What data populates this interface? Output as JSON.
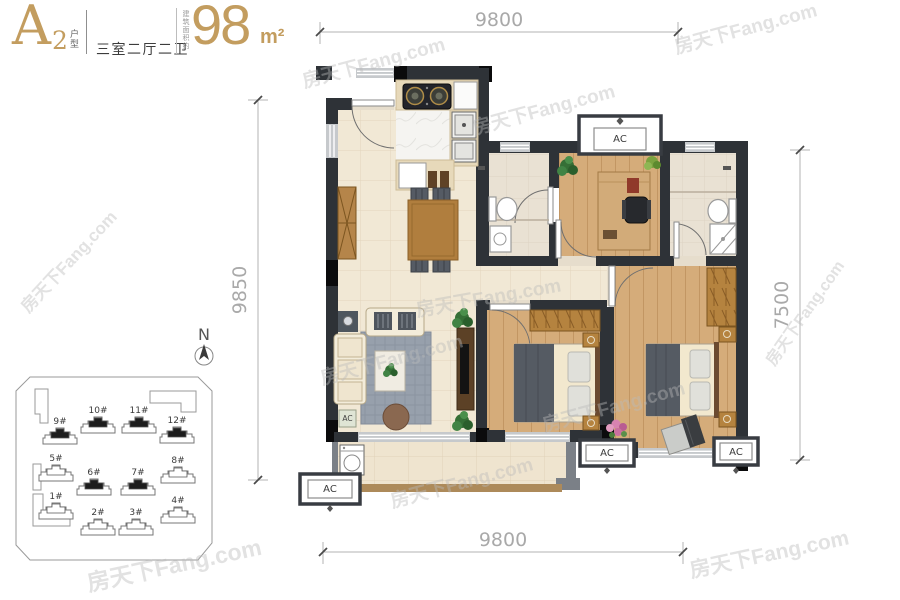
{
  "title": {
    "plan_code": "A",
    "plan_code_index": "2",
    "plan_type_label": "户型",
    "layout_label": "三室二厅二卫",
    "area_prefix": "建筑面积约",
    "area_value": "98",
    "area_unit": "m²"
  },
  "dimensions": {
    "top": "9800",
    "bottom": "9800",
    "left": "9850",
    "right": "7500"
  },
  "compass": {
    "north_label": "N"
  },
  "labels": {
    "ac": "AC"
  },
  "watermark": {
    "text": "房天下Fang.com"
  },
  "site_plan": {
    "buildings": [
      {
        "label": "9#",
        "highlighted": true,
        "fill": "#1d1d1d"
      },
      {
        "label": "10#",
        "highlighted": true,
        "fill": "#1d1d1d"
      },
      {
        "label": "11#",
        "highlighted": true,
        "fill": "#1d1d1d"
      },
      {
        "label": "12#",
        "highlighted": true,
        "fill": "#1d1d1d"
      },
      {
        "label": "5#",
        "highlighted": false,
        "fill": "#ffffff"
      },
      {
        "label": "6#",
        "highlighted": true,
        "fill": "#1d1d1d"
      },
      {
        "label": "7#",
        "highlighted": true,
        "fill": "#1d1d1d"
      },
      {
        "label": "8#",
        "highlighted": false,
        "fill": "#ffffff"
      },
      {
        "label": "1#",
        "highlighted": false,
        "fill": "#ffffff"
      },
      {
        "label": "2#",
        "highlighted": false,
        "fill": "#ffffff"
      },
      {
        "label": "3#",
        "highlighted": false,
        "fill": "#ffffff"
      },
      {
        "label": "4#",
        "highlighted": false,
        "fill": "#ffffff"
      }
    ]
  },
  "colors": {
    "accent_gold": "#c39d5f",
    "wall_dark": "#2e3237",
    "tile_floor": "#f1e8d5",
    "wood_floor": "#d5ac7a",
    "bath_floor": "#e9e1d3",
    "rug": "#97a0ac",
    "railing": "#ad8a5a",
    "dimension_gray": "#a9a9a9"
  }
}
